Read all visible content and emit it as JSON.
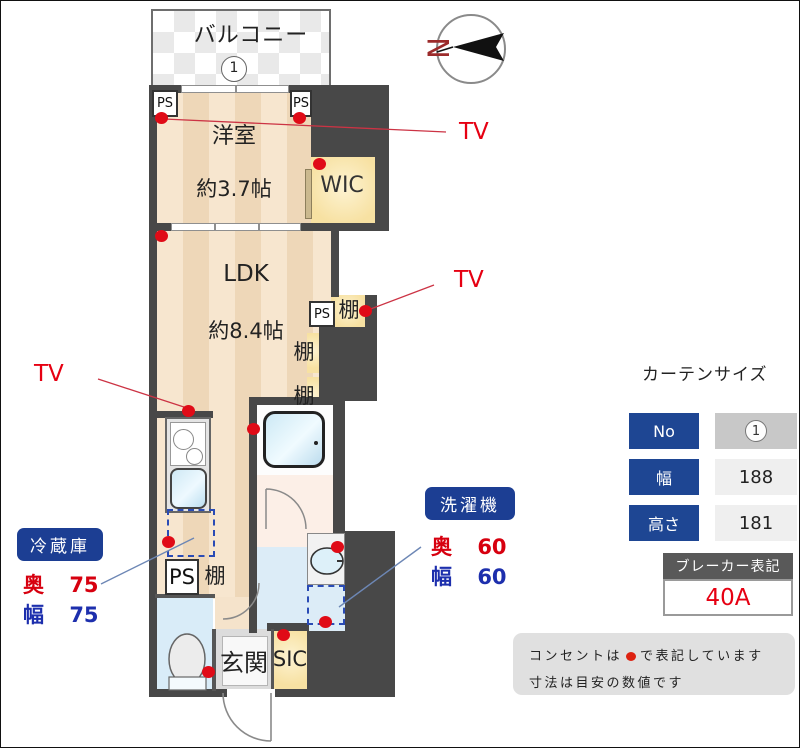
{
  "compass": {
    "north": "N"
  },
  "plan": {
    "balcony": "バルコニー",
    "balcony_no": "1",
    "western_room": "洋室",
    "western_room_size": "約3.7帖",
    "ldk": "LDK",
    "ldk_size": "約8.4帖",
    "wic": "WIC",
    "sic": "SIC",
    "entrance": "玄関",
    "ps": "PS",
    "shelf": "棚"
  },
  "annotations": {
    "tv": "TV",
    "fridge": {
      "title": "冷蔵庫",
      "rows": [
        {
          "label": "奥",
          "value": "75"
        },
        {
          "label": "幅",
          "value": "75"
        }
      ]
    },
    "washer": {
      "title": "洗濯機",
      "rows": [
        {
          "label": "奥",
          "value": "60"
        },
        {
          "label": "幅",
          "value": "60"
        }
      ]
    }
  },
  "curtain": {
    "title": "カーテンサイズ",
    "rows": [
      {
        "label": "No",
        "value": "1"
      },
      {
        "label": "幅",
        "value": "188"
      },
      {
        "label": "高さ",
        "value": "181"
      }
    ]
  },
  "breaker": {
    "title": "ブレーカー表記",
    "value": "40A"
  },
  "note": {
    "line1_before": "コンセントは",
    "line1_after": "で表記しています",
    "line2": "寸法は目安の数値です"
  },
  "colors": {
    "wall": "#484848",
    "accent_navy": "#1c3e93",
    "outlet_red": "#e00b17",
    "value_blue": "#1d2fad"
  }
}
